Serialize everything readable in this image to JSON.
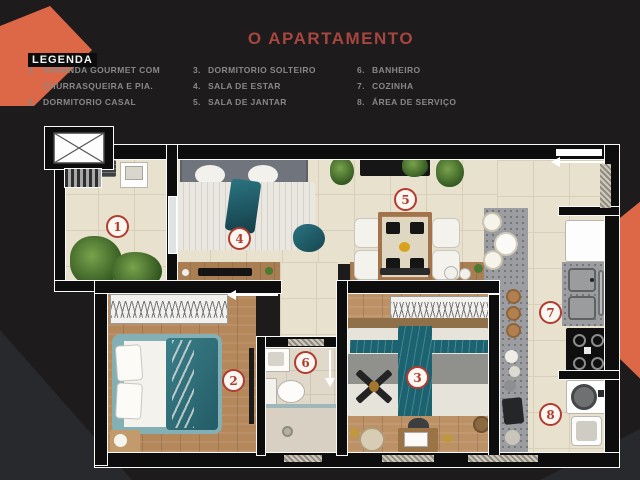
{
  "header": {
    "title": "O APARTAMENTO"
  },
  "legend": {
    "heading": "LEGENDA",
    "columns": [
      {
        "items": [
          {
            "num": "1.",
            "label": "VARANDA GOURMET COM CHURRASQUEIRA E PIA."
          },
          {
            "num": "2.",
            "label": "DORMITORIO CASAL"
          }
        ]
      },
      {
        "items": [
          {
            "num": "3.",
            "label": "DORMITORIO SOLTEIRO"
          },
          {
            "num": "4.",
            "label": "SALA DE ESTAR"
          },
          {
            "num": "5.",
            "label": "SALA DE JANTAR"
          }
        ]
      },
      {
        "items": [
          {
            "num": "6.",
            "label": "BANHEIRO"
          },
          {
            "num": "7.",
            "label": "COZINHA"
          },
          {
            "num": "8.",
            "label": "ÁREA DE SERVIÇO"
          }
        ]
      }
    ]
  },
  "floorplan": {
    "markers": [
      {
        "n": "1"
      },
      {
        "n": "2"
      },
      {
        "n": "3"
      },
      {
        "n": "4"
      },
      {
        "n": "5"
      },
      {
        "n": "6"
      },
      {
        "n": "7"
      },
      {
        "n": "8"
      }
    ]
  },
  "palette": {
    "background": "#1d1b1c",
    "accent_orange": "#dd6848",
    "title_red": "#a7463e",
    "marker_red": "#b23b31",
    "legend_gray": "#8a8886",
    "floor_tile": "#e8e1ce",
    "floor_wood": "#b5885c",
    "teal_accent": "#1b6370",
    "wall_black": "#0d0d0d"
  }
}
